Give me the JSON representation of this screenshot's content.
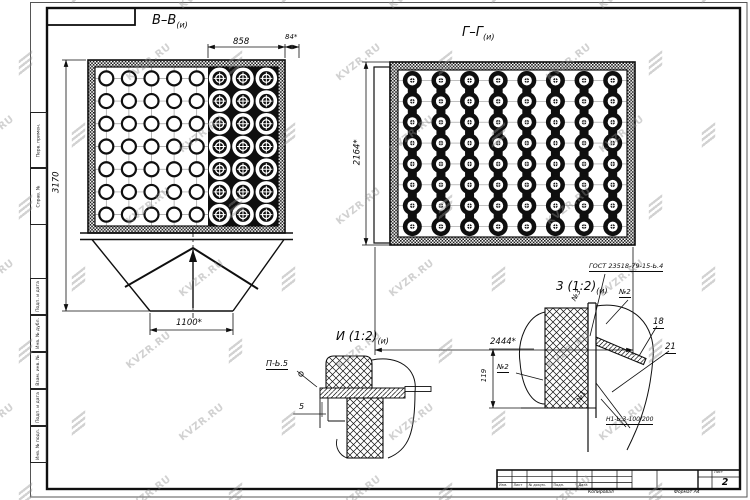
{
  "watermark": {
    "text": "KVZR.RU"
  },
  "views": {
    "bb": {
      "title": "В–В",
      "sub": "(и)",
      "dim_top": "858",
      "dim_top_right": "84*",
      "dim_left": "3170",
      "dim_bottom": "1100*",
      "grid": {
        "rows": 7,
        "cols_small": 5,
        "cols_rings": 3
      }
    },
    "gg": {
      "title": "Г–Г",
      "sub": "(и)",
      "dim_left": "2164*",
      "dim_bottom": "2444*",
      "grid": {
        "rows": 8,
        "cols": 8
      }
    },
    "i": {
      "title": "И (1:2)",
      "sub": "(и)",
      "weld_label": "П-Ь.5",
      "dim_thickness": "5"
    },
    "z": {
      "title": "3 (1:2)",
      "sub": "(и)",
      "gost": "ГОСТ 23518-79-15-Ь.4",
      "pos_n3": "№3",
      "pos_n2_top": "№2",
      "pos_18": "18",
      "pos_21": "21",
      "pos_n2_left": "№2",
      "dim_height": "119",
      "pos_n1": "№1",
      "weld_label": "Н1-Ь.3-100/200"
    }
  },
  "frame": {
    "sheet_label": "Лист",
    "sheet_number": "2",
    "copied_label": "Копировал",
    "format_label": "Формат А4",
    "stamp_cols": [
      "Изм.",
      "Лист",
      "№ докум.",
      "Подп.",
      "Дата"
    ],
    "side_labels": [
      "Перв. примен.",
      "Справ. №",
      "Подп. и дата",
      "Инв. № дубл.",
      "Взам. инв. №",
      "Подп. и дата",
      "Инв. № подл."
    ]
  }
}
